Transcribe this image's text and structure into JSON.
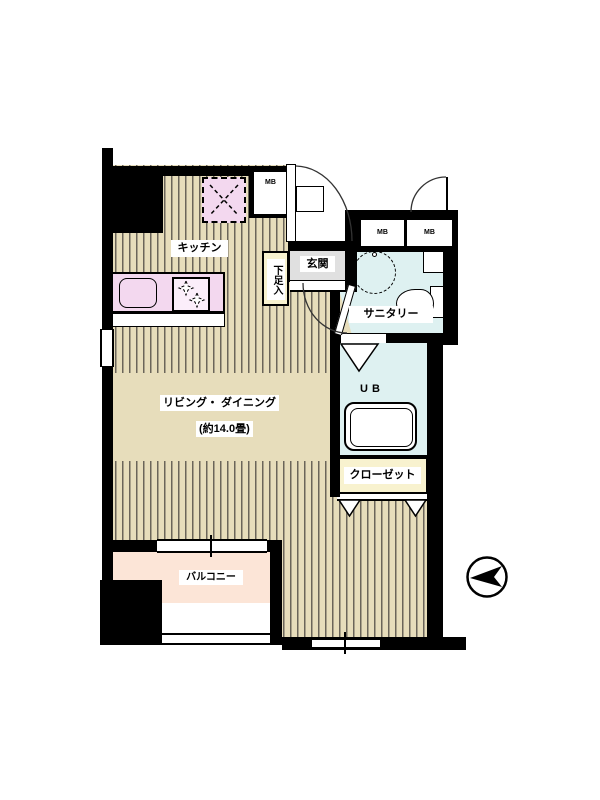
{
  "floor_plan": {
    "rooms": {
      "kitchen": {
        "label": "キッチン"
      },
      "living_dining": {
        "label": "リビング・ ダイニング",
        "size": "(約14.0畳)"
      },
      "entrance": {
        "label": "玄関"
      },
      "shoe_cabinet": {
        "label": "下足入"
      },
      "sanitary": {
        "label": "サニタリー"
      },
      "unit_bath": {
        "label": "UB"
      },
      "closet": {
        "label": "クローゼット"
      },
      "balcony": {
        "label": "バルコニー"
      }
    },
    "meter_boxes": [
      {
        "label": "MB"
      },
      {
        "label": "MB"
      },
      {
        "label": "MB"
      }
    ],
    "symbols": {
      "compass": "north-arrow-pointing-left",
      "refrigerator_space": "dashed square with X",
      "stove": "two burner stars",
      "washbasin": "dashed circle",
      "toilet": "bowl with tank",
      "bathtub": "rounded rectangle tub"
    },
    "colors": {
      "wall": "#000000",
      "flooring": "#e7ddbb",
      "flooring_stripe": "#6b655a",
      "water_area": "#def1f1",
      "storage": "#f8f2cf",
      "kitchen_fixture": "#f3d8ef",
      "balcony": "#fce5d7",
      "entrance_floor": "#e0e0e0"
    }
  }
}
